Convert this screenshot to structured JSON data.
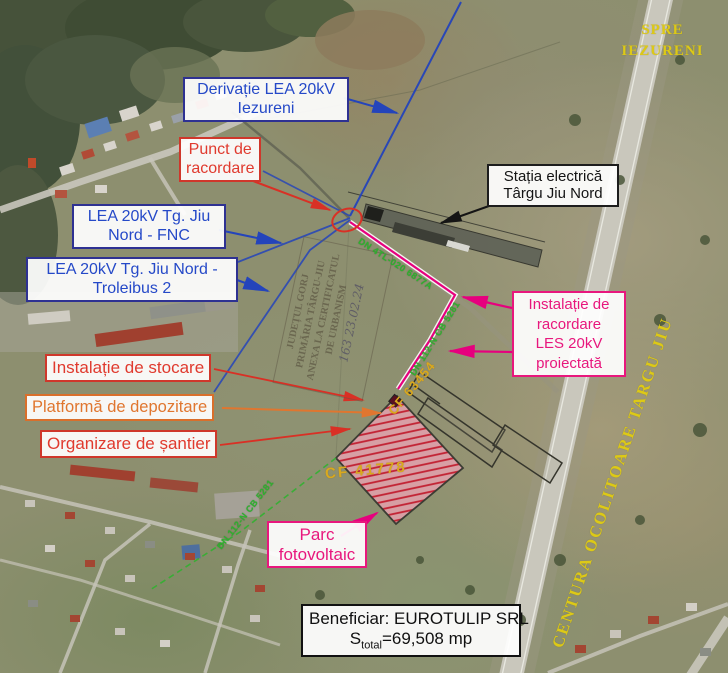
{
  "annotations": {
    "derivatie": {
      "l1": "Derivație LEA 20kV",
      "l2": "Iezureni"
    },
    "punct": {
      "l1": "Punct de",
      "l2": "racordare"
    },
    "statia": {
      "l1": "Stația electrică",
      "l2": "Târgu Jiu Nord"
    },
    "fnc": {
      "l1": "LEA 20kV Tg. Jiu",
      "l2": "Nord - FNC"
    },
    "troleibus": {
      "l1": "LEA 20kV Tg. Jiu Nord -",
      "l2": "Troleibus 2"
    },
    "les": {
      "l1": "Instalație de",
      "l2": "racordare",
      "l3": "LES 20kV",
      "l4": "proiectată"
    },
    "stocare": {
      "l1": "Instalație de stocare"
    },
    "depozitare": {
      "l1": "Platformă de depozitare"
    },
    "santier": {
      "l1": "Organizare de șantier"
    },
    "parc": {
      "l1": "Parc",
      "l2": "fotovoltaic"
    }
  },
  "beneficiary": {
    "l1": "Beneficiar: EUROTULIP SRL",
    "s_prefix": "S",
    "s_sub": "total",
    "s_value": "=69,508 mp"
  },
  "road_labels": {
    "spre_l1": "SPRE",
    "spre_l2": "IEZURENI",
    "centura": "CENTURA OCOLITOARE TARGU JIU"
  },
  "parcel_labels": {
    "cf_upper": "CF 63454",
    "cf_lower": "CF 41778"
  },
  "route_survey_labels": {
    "a": "DN 4TL-020 6877A",
    "b": "DN 112-N CB 5281",
    "c": "DN 112-N CB 5281"
  },
  "stamp": {
    "l1": "JUDEȚUL GORJ",
    "l2": "PRIMĂRIA TÂRGU-JIU",
    "l3": "ANEXA LA CERTIFICATUL",
    "l4": "DE URBANISM",
    "hand": "163  23.02.24"
  },
  "colors": {
    "lea_blue": "#2549c8",
    "connection_red": "#d93025",
    "les_magenta": "#e6007e",
    "platform_orange": "#e0762f",
    "road_label_yellow": "#ddc916",
    "boundary_green": "#2db32d",
    "parcel_fill_pink": "#eaa3b1",
    "parcel_hatch_red": "#c22233"
  }
}
